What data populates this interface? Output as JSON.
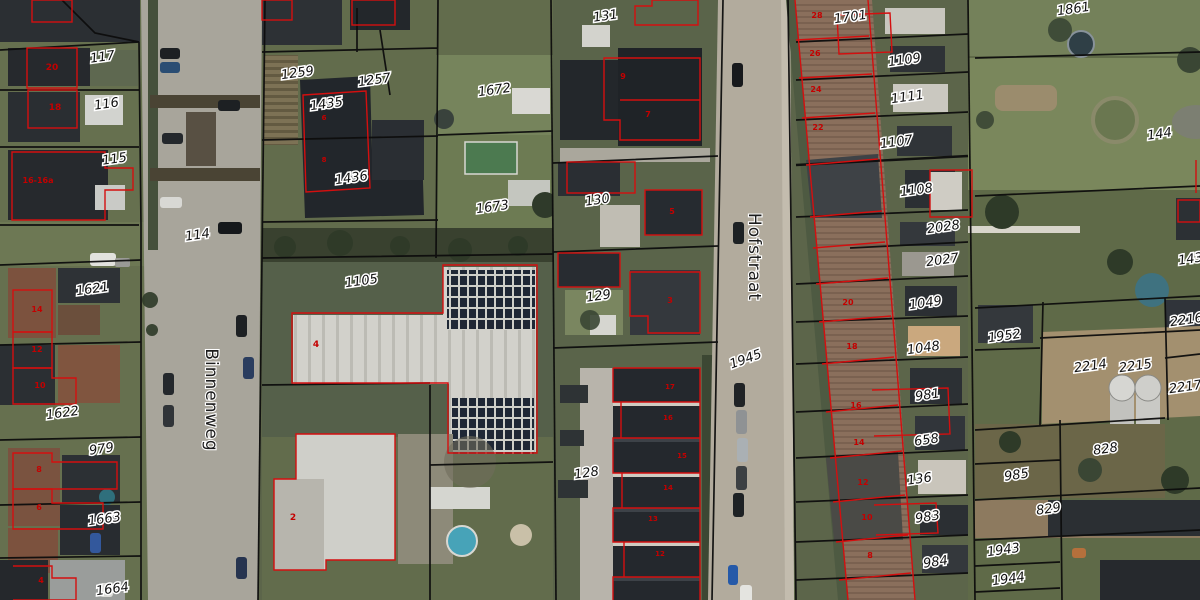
{
  "viewer": {
    "description": "Aerial cadastral map with parcel boundaries and building outlines",
    "colors": {
      "parcel_line": "#0d0d0d",
      "building_outline": "#d40f0f",
      "parcel_label_text": "#111111",
      "parcel_label_halo": "#ffffff",
      "house_number_text": "#c40000",
      "road": "#b2ab9d",
      "brick_roof_row": "#8a6f5c",
      "dark_roof": "#24282d",
      "lawn": "#6f7c55",
      "bare_soil": "#a3906f",
      "solar_panel": "#1f2836"
    }
  },
  "streets": [
    {
      "name": "Binnenweg",
      "x": 206,
      "y": 400,
      "rotation": 90
    },
    {
      "name": "Hofstraat",
      "x": 749,
      "y": 257,
      "rotation": 90
    }
  ],
  "parcels": [
    {
      "id": "117",
      "x": 103,
      "y": 61
    },
    {
      "id": "116",
      "x": 107,
      "y": 108
    },
    {
      "id": "115",
      "x": 115,
      "y": 163
    },
    {
      "id": "114",
      "x": 198,
      "y": 239
    },
    {
      "id": "1621",
      "x": 93,
      "y": 293
    },
    {
      "id": "1622",
      "x": 63,
      "y": 417
    },
    {
      "id": "979",
      "x": 102,
      "y": 453
    },
    {
      "id": "1663",
      "x": 105,
      "y": 523
    },
    {
      "id": "1664",
      "x": 113,
      "y": 593
    },
    {
      "id": "1259",
      "x": 298,
      "y": 77
    },
    {
      "id": "1257",
      "x": 375,
      "y": 84
    },
    {
      "id": "1435",
      "x": 327,
      "y": 108
    },
    {
      "id": "1436",
      "x": 352,
      "y": 182
    },
    {
      "id": "1672",
      "x": 495,
      "y": 94
    },
    {
      "id": "1673",
      "x": 493,
      "y": 211
    },
    {
      "id": "1105",
      "x": 362,
      "y": 285
    },
    {
      "id": "131",
      "x": 606,
      "y": 20
    },
    {
      "id": "130",
      "x": 598,
      "y": 204
    },
    {
      "id": "129",
      "x": 599,
      "y": 300
    },
    {
      "id": "128",
      "x": 587,
      "y": 477
    },
    {
      "id": "1945",
      "x": 747,
      "y": 363,
      "rotation": -20
    },
    {
      "id": "1701",
      "x": 851,
      "y": 21
    },
    {
      "id": "1109",
      "x": 905,
      "y": 64
    },
    {
      "id": "1111",
      "x": 908,
      "y": 101
    },
    {
      "id": "1107",
      "x": 897,
      "y": 146
    },
    {
      "id": "1108",
      "x": 917,
      "y": 194
    },
    {
      "id": "2028",
      "x": 944,
      "y": 231
    },
    {
      "id": "2027",
      "x": 943,
      "y": 264
    },
    {
      "id": "1049",
      "x": 926,
      "y": 307
    },
    {
      "id": "1048",
      "x": 924,
      "y": 352
    },
    {
      "id": "981",
      "x": 928,
      "y": 399
    },
    {
      "id": "658",
      "x": 927,
      "y": 444
    },
    {
      "id": "136",
      "x": 920,
      "y": 483
    },
    {
      "id": "983",
      "x": 928,
      "y": 521
    },
    {
      "id": "984",
      "x": 936,
      "y": 566
    },
    {
      "id": "1861",
      "x": 1074,
      "y": 13
    },
    {
      "id": "144",
      "x": 1160,
      "y": 138
    },
    {
      "id": "143",
      "x": 1191,
      "y": 263
    },
    {
      "id": "1952",
      "x": 1005,
      "y": 340
    },
    {
      "id": "2214",
      "x": 1091,
      "y": 370
    },
    {
      "id": "2215",
      "x": 1136,
      "y": 370
    },
    {
      "id": "2216",
      "x": 1187,
      "y": 324
    },
    {
      "id": "2217",
      "x": 1186,
      "y": 391
    },
    {
      "id": "828",
      "x": 1106,
      "y": 453
    },
    {
      "id": "985",
      "x": 1017,
      "y": 479
    },
    {
      "id": "829",
      "x": 1049,
      "y": 513
    },
    {
      "id": "1943",
      "x": 1004,
      "y": 554
    },
    {
      "id": "1944",
      "x": 1009,
      "y": 583
    }
  ],
  "house_numbers": [
    {
      "n": "20",
      "x": 52,
      "y": 70,
      "size": 9
    },
    {
      "n": "18",
      "x": 55,
      "y": 110,
      "size": 9
    },
    {
      "n": "16-16a",
      "x": 38,
      "y": 183,
      "size": 8
    },
    {
      "n": "14",
      "x": 37,
      "y": 312,
      "size": 8
    },
    {
      "n": "12",
      "x": 37,
      "y": 352,
      "size": 8
    },
    {
      "n": "10",
      "x": 40,
      "y": 388,
      "size": 8
    },
    {
      "n": "8",
      "x": 39,
      "y": 472,
      "size": 8
    },
    {
      "n": "6",
      "x": 39,
      "y": 510,
      "size": 8
    },
    {
      "n": "4",
      "x": 41,
      "y": 583,
      "size": 8
    },
    {
      "n": "6",
      "x": 324,
      "y": 120,
      "size": 7
    },
    {
      "n": "8",
      "x": 324,
      "y": 162,
      "size": 7
    },
    {
      "n": "4",
      "x": 316,
      "y": 347,
      "size": 9
    },
    {
      "n": "2",
      "x": 293,
      "y": 520,
      "size": 9
    },
    {
      "n": "9",
      "x": 623,
      "y": 79,
      "size": 8
    },
    {
      "n": "7",
      "x": 648,
      "y": 117,
      "size": 8
    },
    {
      "n": "5",
      "x": 672,
      "y": 214,
      "size": 8
    },
    {
      "n": "3",
      "x": 670,
      "y": 303,
      "size": 8
    },
    {
      "n": "17",
      "x": 670,
      "y": 389,
      "size": 7
    },
    {
      "n": "16",
      "x": 668,
      "y": 420,
      "size": 7
    },
    {
      "n": "15",
      "x": 682,
      "y": 458,
      "size": 7
    },
    {
      "n": "14",
      "x": 668,
      "y": 490,
      "size": 7
    },
    {
      "n": "13",
      "x": 653,
      "y": 521,
      "size": 7
    },
    {
      "n": "12",
      "x": 660,
      "y": 556,
      "size": 7
    },
    {
      "n": "28",
      "x": 817,
      "y": 18,
      "size": 8
    },
    {
      "n": "26",
      "x": 815,
      "y": 56,
      "size": 8
    },
    {
      "n": "24",
      "x": 816,
      "y": 92,
      "size": 8
    },
    {
      "n": "22",
      "x": 818,
      "y": 130,
      "size": 8
    },
    {
      "n": "20",
      "x": 848,
      "y": 305,
      "size": 8
    },
    {
      "n": "18",
      "x": 852,
      "y": 349,
      "size": 8
    },
    {
      "n": "16",
      "x": 856,
      "y": 408,
      "size": 8
    },
    {
      "n": "14",
      "x": 859,
      "y": 445,
      "size": 8
    },
    {
      "n": "12",
      "x": 863,
      "y": 485,
      "size": 8
    },
    {
      "n": "10",
      "x": 867,
      "y": 520,
      "size": 8
    },
    {
      "n": "8",
      "x": 870,
      "y": 558,
      "size": 8
    }
  ]
}
